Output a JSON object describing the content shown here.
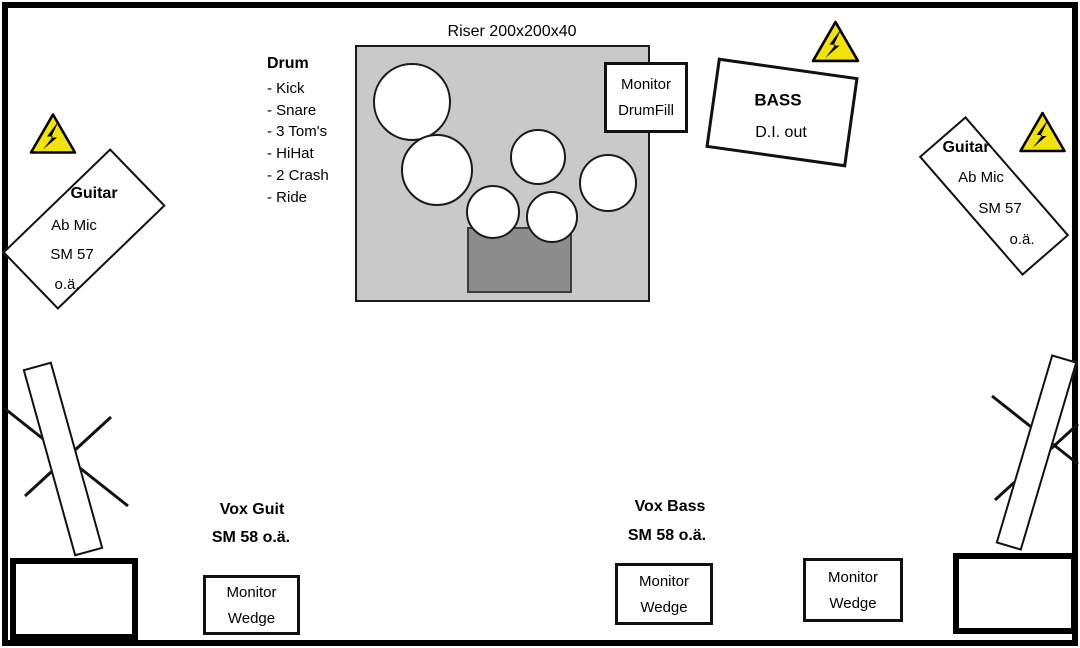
{
  "riser": {
    "label": "Riser 200x200x40"
  },
  "drum_legend": {
    "title": "Drum",
    "items": [
      "- Kick",
      "- Snare",
      "- 3 Tom's",
      "- HiHat",
      "- 2 Crash",
      "- Ride"
    ]
  },
  "monitor_drumfill": {
    "line1": "Monitor",
    "line2": "DrumFill"
  },
  "bass": {
    "name": "BASS",
    "note": "D.I. out"
  },
  "guitar_left": {
    "lines": [
      "Guitar",
      "Ab Mic",
      "SM 57",
      "o.ä."
    ]
  },
  "guitar_right": {
    "lines": [
      "Guitar",
      "Ab Mic",
      "SM 57",
      "o.ä."
    ]
  },
  "vox_guit": {
    "line1": "Vox Guit",
    "line2": "SM 58 o.ä."
  },
  "vox_bass": {
    "line1": "Vox Bass",
    "line2": "SM 58 o.ä."
  },
  "monitor_wedge": {
    "line1": "Monitor",
    "line2": "Wedge"
  },
  "icons": {
    "power_warning": "high-voltage-warning-triangle"
  },
  "colors": {
    "ink": "#000000",
    "riser_gray": "#c9c9c9",
    "kick_gray": "#8d8d8d",
    "warning_yellow": "#f2e20c"
  }
}
